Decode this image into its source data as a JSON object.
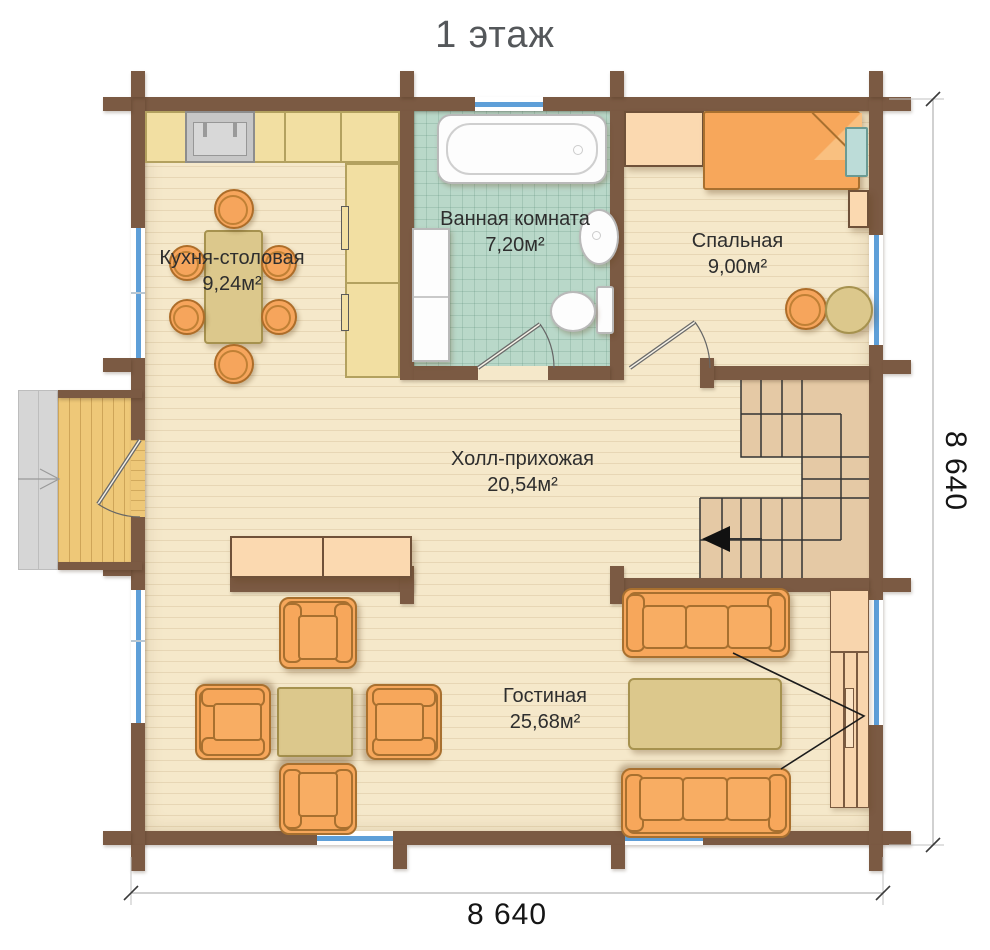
{
  "title": "1 этаж",
  "rooms": {
    "kitchen": {
      "name": "Кухня-столовая",
      "area": "9,24м²"
    },
    "bathroom": {
      "name": "Ванная комната",
      "area": "7,20м²"
    },
    "bedroom": {
      "name": "Спальная",
      "area": "9,00м²"
    },
    "hall": {
      "name": "Холл-прихожая",
      "area": "20,54м²"
    },
    "living": {
      "name": "Гостиная",
      "area": "25,68м²"
    }
  },
  "dimensions": {
    "right": "8 640",
    "bottom": "8 640"
  },
  "colors": {
    "wall": "#7b5a43",
    "floor": "#f5e8ca",
    "bath_tile": "#b9d8c9",
    "stair": "#e5c9a5",
    "porch_deck": "#eec878",
    "furniture_orange": "#f7a75b",
    "window_blue": "#5e9fd8",
    "counter_yellow": "#f2dfa2",
    "table_khaki": "#dcc88c",
    "cabinet_peach": "#fbd9b0",
    "pillow_teal": "#bcdcd8"
  }
}
